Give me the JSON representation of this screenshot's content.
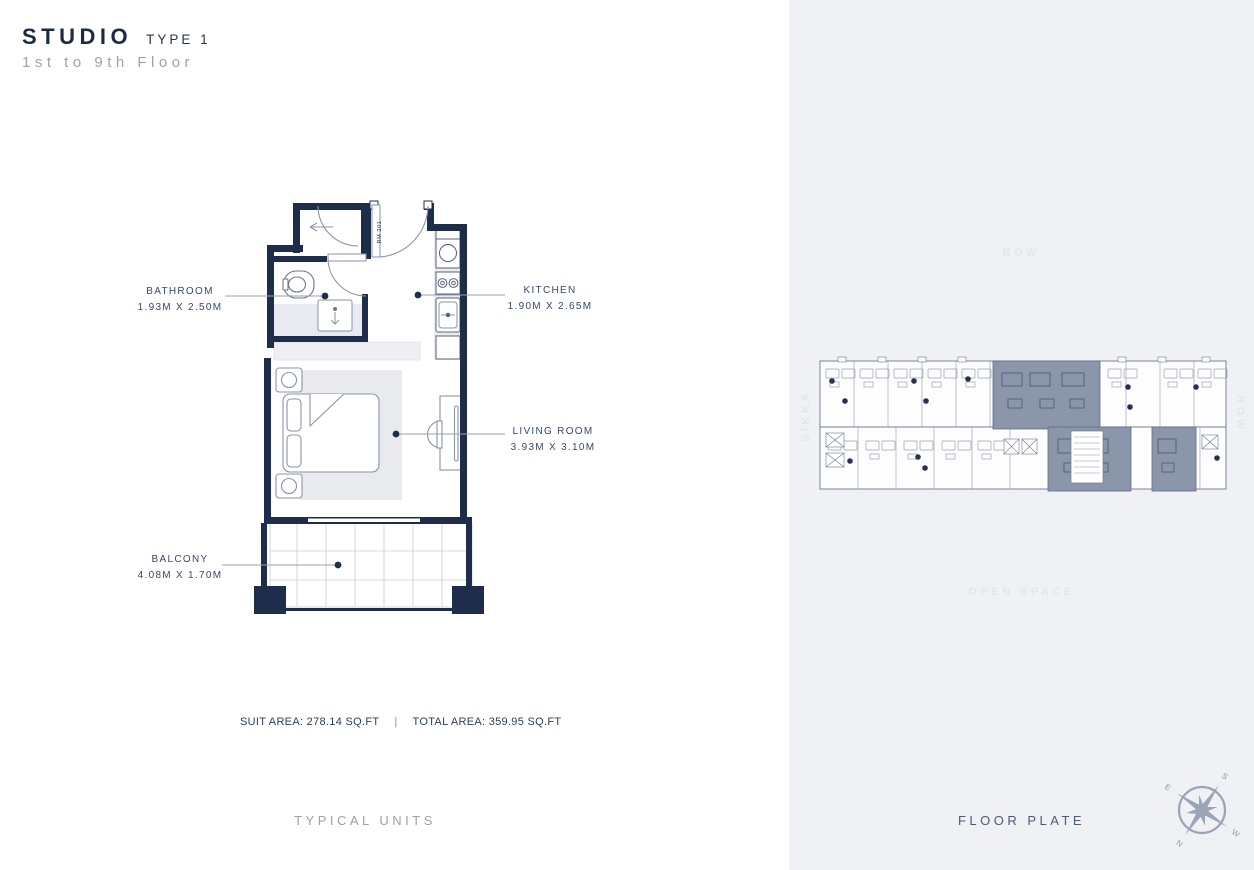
{
  "title": {
    "main": "STUDIO",
    "type": "TYPE 1",
    "floors": "1st to 9th Floor"
  },
  "plan": {
    "room_tag": "RM 201",
    "rooms": {
      "bathroom": {
        "name": "BATHROOM",
        "dims": "1.93M X 2.50M"
      },
      "kitchen": {
        "name": "KITCHEN",
        "dims": "1.90M X 2.65M"
      },
      "living": {
        "name": "LIVING ROOM",
        "dims": "3.93M X 3.10M"
      },
      "balcony": {
        "name": "BALCONY",
        "dims": "4.08M X 1.70M"
      }
    }
  },
  "areas": {
    "suit": "SUIT AREA: 278.14 SQ.FT",
    "separator": "|",
    "total": "TOTAL AREA: 359.95 SQ.FT"
  },
  "captions": {
    "left": "TYPICAL UNITS",
    "right": "FLOOR PLATE"
  },
  "floor_plate": {
    "row_top": "ROW",
    "open_space": "OPEN SPACE",
    "sikka": "SIKKA",
    "row_right": "ROW"
  },
  "compass": {
    "n": "N",
    "e": "E",
    "s": "S",
    "w": "W"
  },
  "colors": {
    "wall_navy": "#1f2d4d",
    "label_text": "#35496b",
    "panel_bg": "#f0f1f4",
    "highlight_unit": "#8c96ab",
    "faint_text": "#e3e6ec",
    "furniture_stroke": "#8a93a8"
  }
}
